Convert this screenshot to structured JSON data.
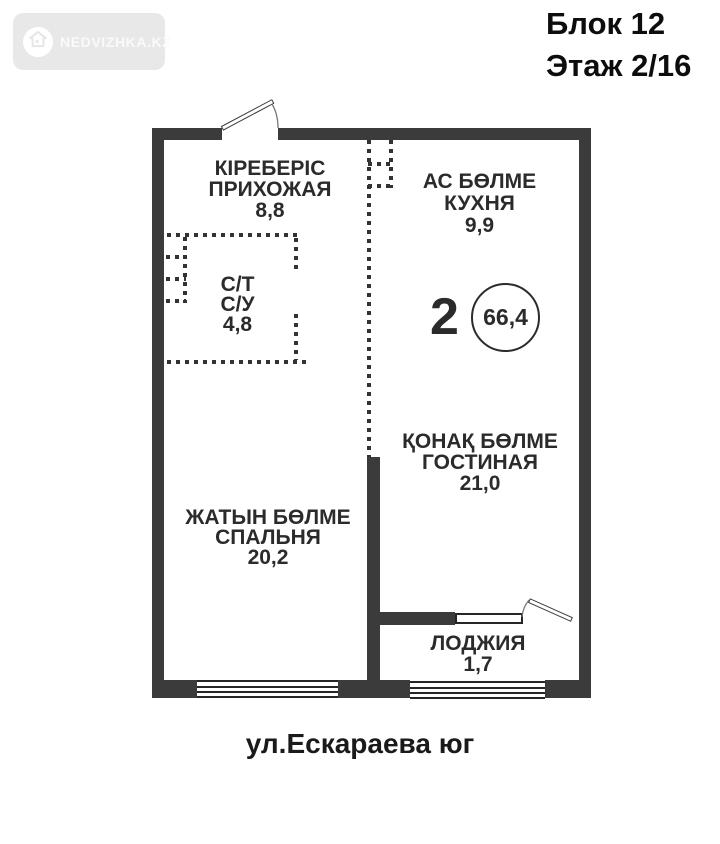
{
  "watermark": {
    "brand": "NEDVIZHKA.KZ"
  },
  "header": {
    "block": "Блок 12",
    "floor": "Этаж 2/16"
  },
  "plan": {
    "rooms": {
      "entry": {
        "name_kk": "КІРЕБЕРІС",
        "name_ru": "ПРИХОЖАЯ",
        "area": "8,8"
      },
      "kitchen": {
        "name_kk": "АС БӨЛМЕ",
        "name_ru": "КУХНЯ",
        "area": "9,9"
      },
      "bathroom": {
        "name_kk": "С/Т",
        "name_ru": "С/У",
        "area": "4,8"
      },
      "living": {
        "name_kk": "ҚОНАҚ БӨЛМЕ",
        "name_ru": "ГОСТИНАЯ",
        "area": "21,0"
      },
      "bedroom": {
        "name_kk": "ЖАТЫН БӨЛМЕ",
        "name_ru": "СПАЛЬНЯ",
        "area": "20,2"
      },
      "loggia": {
        "name_ru": "ЛОДЖИЯ",
        "area": "1,7"
      }
    },
    "summary": {
      "room_count": "2",
      "total_area": "66,4"
    }
  },
  "footer": {
    "address": "ул.Ескараева юг"
  },
  "colors": {
    "wall": "#3b3b3b",
    "text": "#2b2b2b",
    "watermark_bg": "#e8e8e8"
  }
}
